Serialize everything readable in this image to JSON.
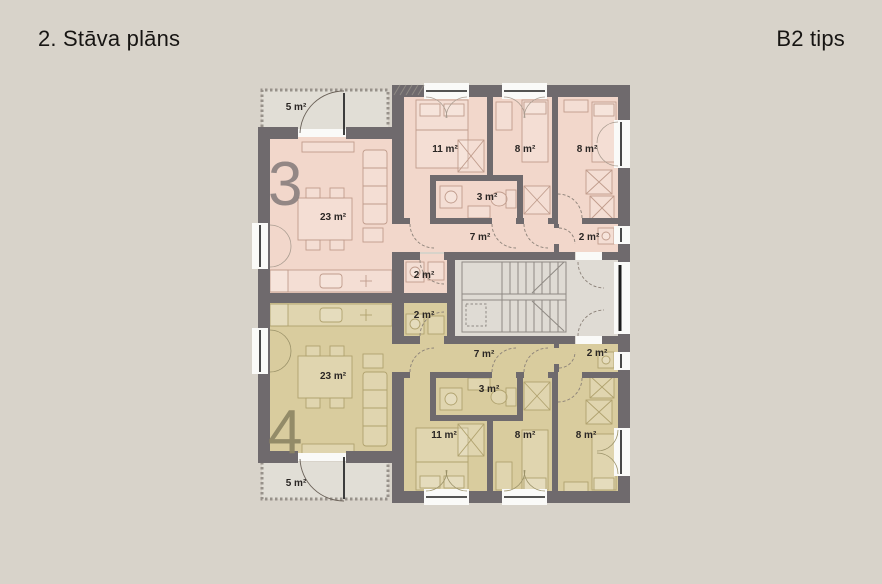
{
  "header": {
    "title": "2. Stāva plāns",
    "type": "B2 tips"
  },
  "colors": {
    "background": "#d8d3ca",
    "wall": "#6f6a6d",
    "apartment3_fill": "#f2d7cb",
    "apartment4_fill": "#d9cc9e",
    "stairwell_fill": "#dfdbd4",
    "balcony_fill": "#e1ded6",
    "label_text": "#2a2624",
    "apartment3_number": "#8b8180",
    "apartment4_number": "#8e8664",
    "window_frame": "#1c1c1c"
  },
  "apartments": [
    {
      "number": "3",
      "rooms": {
        "living": "23 m²",
        "bedroom_large": "11 m²",
        "bedroom_mid": "8 m²",
        "bedroom_right": "8 m²",
        "bathroom": "3 m²",
        "hall": "7 m²",
        "wc": "2 m²",
        "utility": "2 m²",
        "balcony": "5 m²"
      }
    },
    {
      "number": "4",
      "rooms": {
        "living": "23 m²",
        "bedroom_large": "11 m²",
        "bedroom_mid": "8 m²",
        "bedroom_right": "8 m²",
        "bathroom": "3 m²",
        "hall": "7 m²",
        "wc": "2 m²",
        "utility": "2 m²",
        "balcony": "5 m²"
      }
    }
  ]
}
